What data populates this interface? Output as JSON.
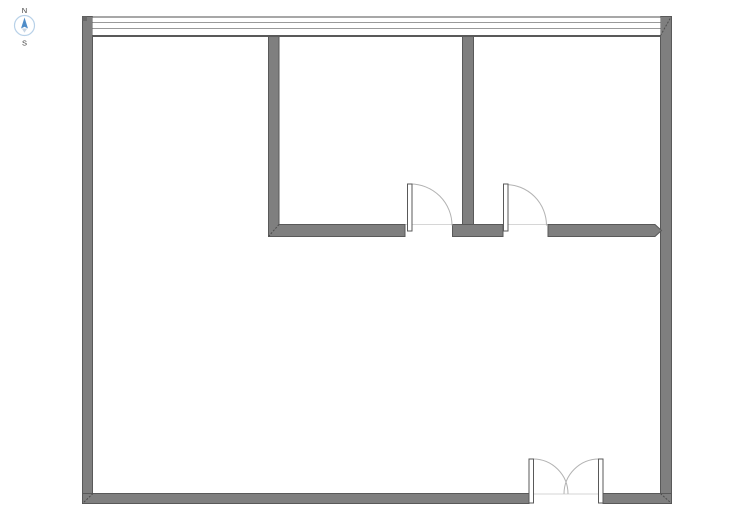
{
  "compass": {
    "north_label": "N",
    "south_label": "S"
  },
  "colors": {
    "background": "#ffffff",
    "wall_fill": "#7f7f7f",
    "wall_outline": "#595959",
    "wall_corner_cap": "#696969",
    "mitre_line": "#4d4d4d",
    "window_line_top": "#8a8a8a",
    "window_line_light": "#9a9a9a",
    "window_line_inner": "#595959",
    "door_leaf_fill": "#ffffff",
    "door_leaf_outline": "#595959",
    "door_swing_arc": "#b3b3b3",
    "threshold_line": "#d6d6d6",
    "compass_ring": "#b8d1e8",
    "compass_fill": "#ffffff",
    "compass_needle_north": "#4e8cc8",
    "compass_needle_south": "#c9d6e4",
    "compass_label_color": "#404040"
  }
}
